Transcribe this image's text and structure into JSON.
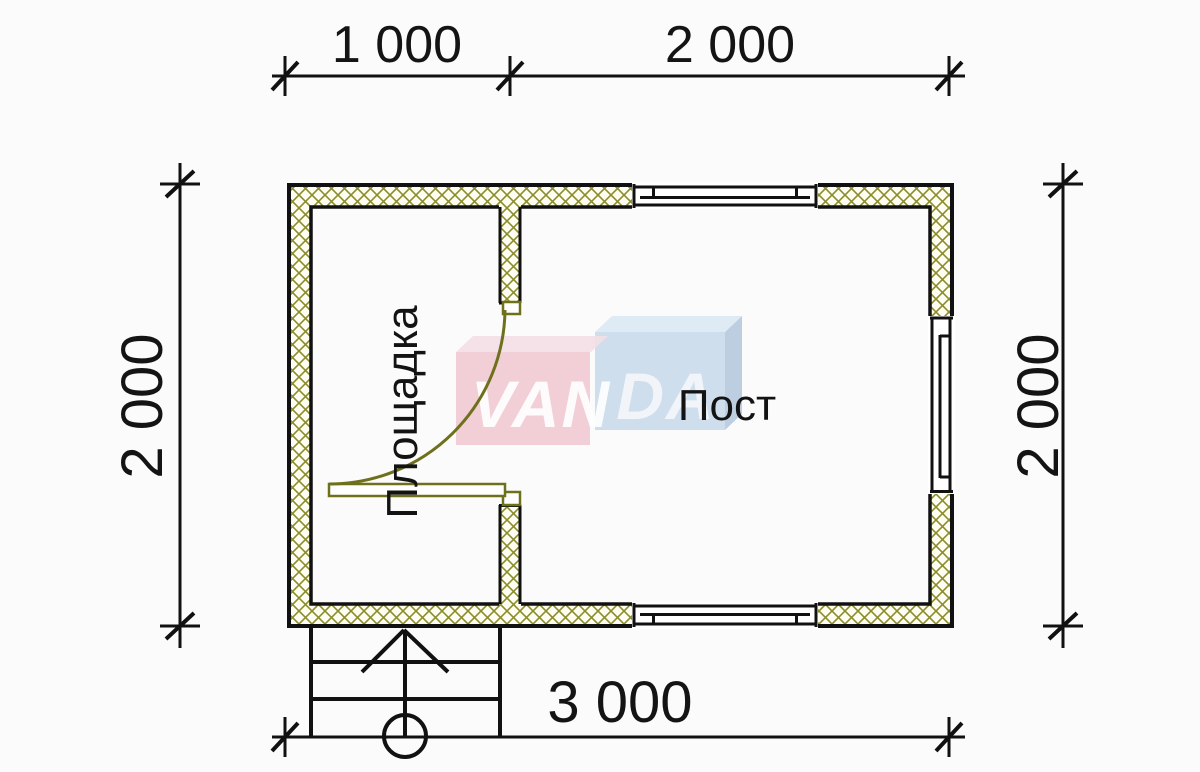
{
  "drawing": {
    "dimensions": {
      "top_left": "1 000",
      "top_right": "2 000",
      "left": "2 000",
      "right": "2 000",
      "bottom": "3 000"
    },
    "rooms": {
      "left": "Площадка",
      "right": "Пост"
    },
    "watermark": {
      "left": "VAN",
      "right": "DA"
    }
  },
  "colors": {
    "paper": "#fbfbfb",
    "line": "#111111",
    "hatch": "#8c8c2c",
    "wall-fill": "#fdfdf1",
    "door": "#6e701c",
    "logo-pink": "#f2ccd4",
    "logo-pink-top": "#f3dde4",
    "logo-blue": "#ccdcec",
    "logo-blue-top": "#dceaf4",
    "logo-blue-side": "#b9cbdf"
  }
}
